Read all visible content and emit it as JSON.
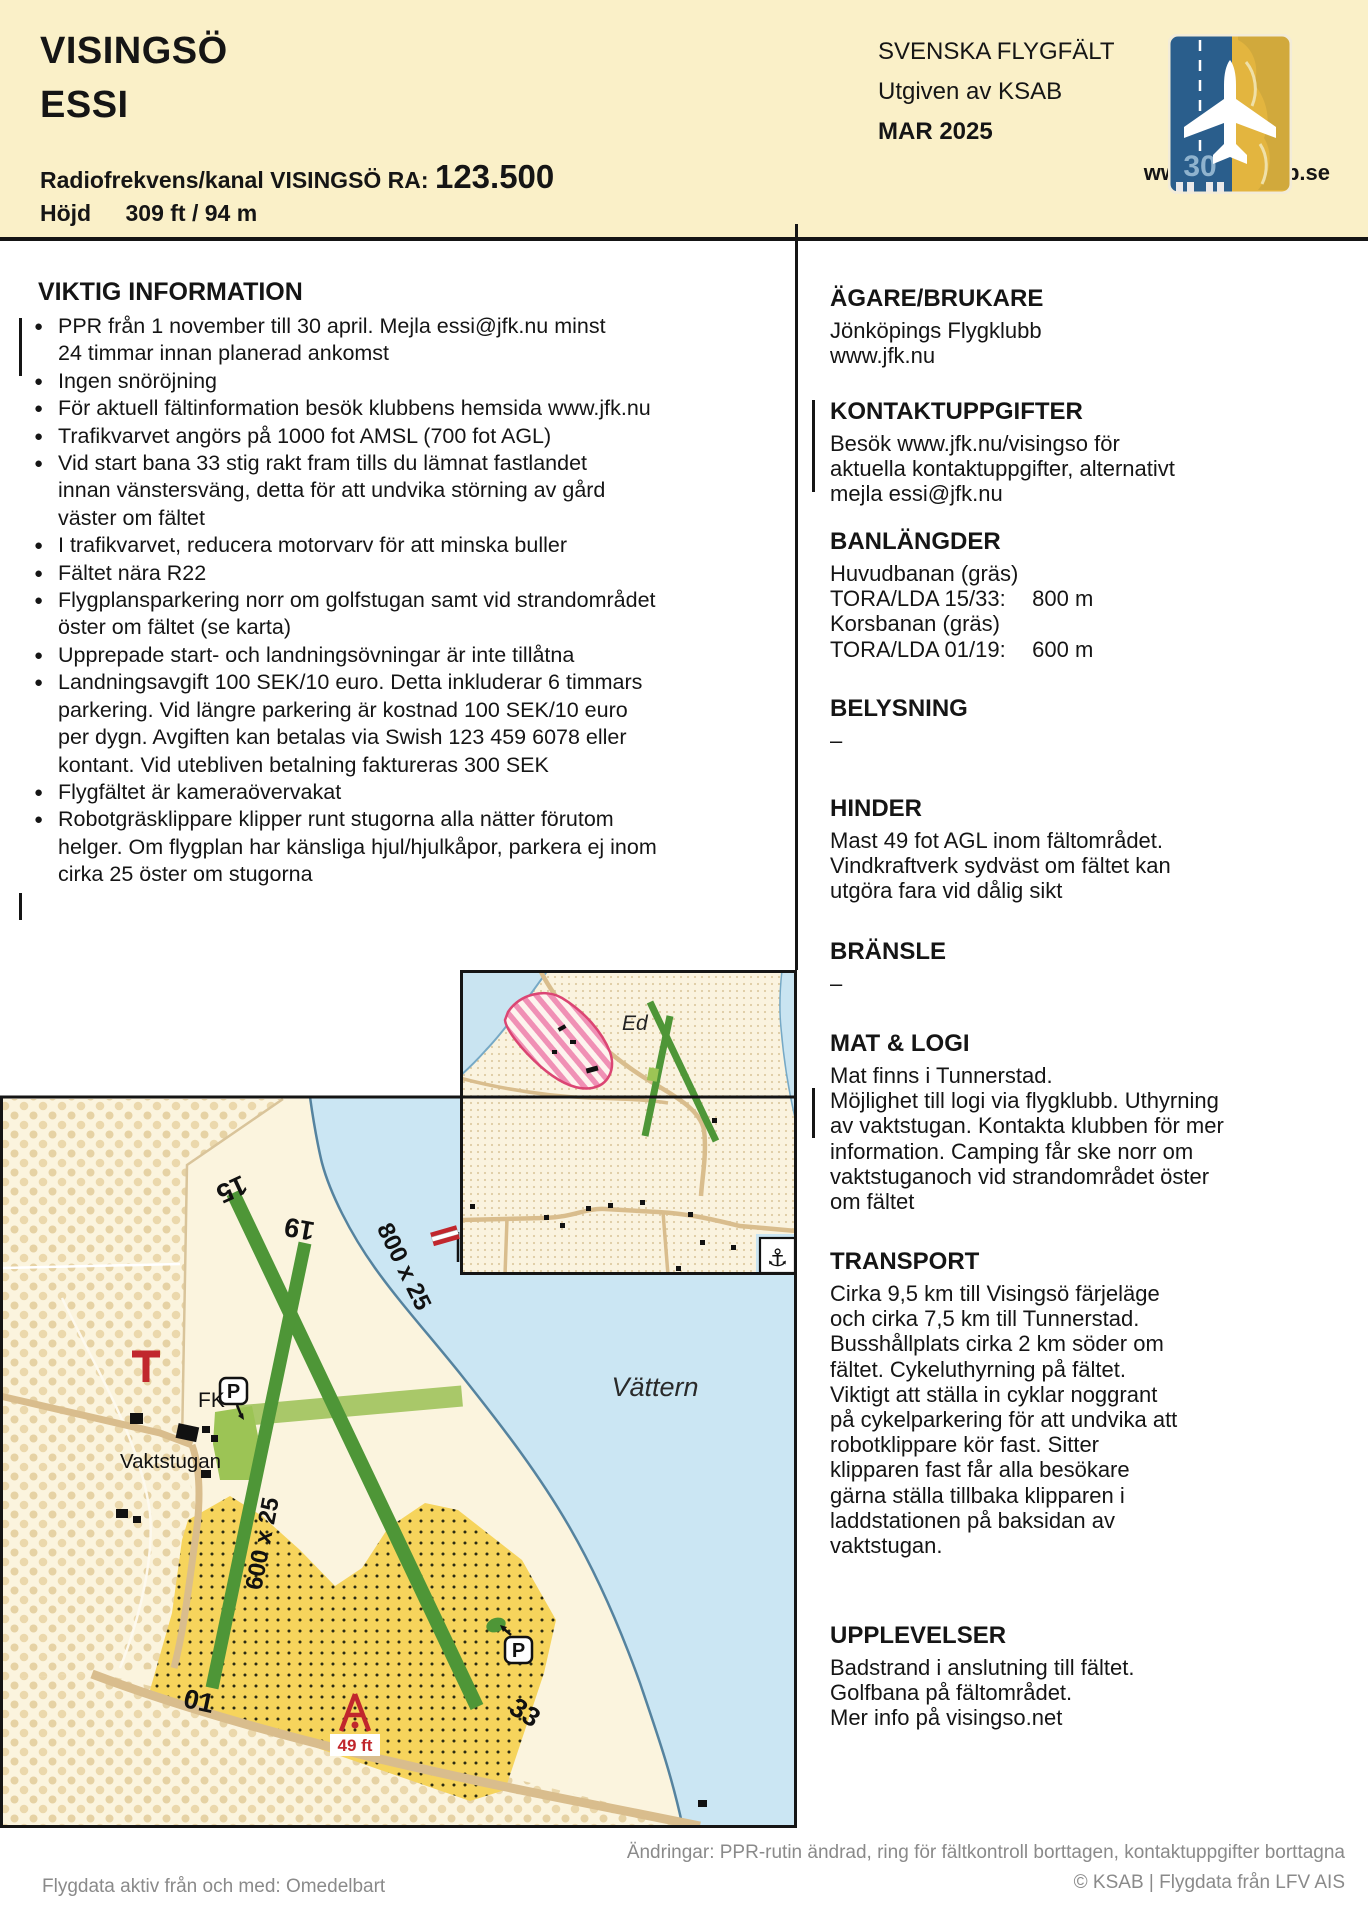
{
  "header": {
    "title_line1": "VISINGSÖ",
    "title_line2": "ESSI",
    "radio_label": "Radiofrekvens/kanal VISINGSÖ RA:",
    "radio_value": "123.500",
    "elevation_label": "Höjd",
    "elevation_value": "309 ft / 94 m",
    "series_title": "SVENSKA FLYGFÄLT",
    "publisher": "Utgiven av KSAB",
    "edition": "MAR 2025",
    "website": "www.pilotshop.se",
    "logo_runway_number": "30"
  },
  "important": {
    "heading": "VIKTIG INFORMATION",
    "bullet_marker": "●",
    "bullets": [
      "PPR från 1 november till 30 april. Mejla essi@jfk.nu minst\n24 timmar innan planerad ankomst",
      "Ingen snöröjning",
      "För aktuell fältinformation besök klubbens hemsida www.jfk.nu",
      "Trafikvarvet angörs på 1000 fot AMSL (700 fot AGL)",
      "Vid start bana 33 stig rakt fram tills du lämnat fastlandet\ninnan vänstersväng, detta för att undvika störning av gård\nväster om fältet",
      "I trafikvarvet, reducera motorvarv för att minska buller",
      "Fältet nära R22",
      "Flygplansparkering norr om golfstugan samt vid strandområdet\nöster om fältet (se karta)",
      "Upprepade start- och landningsövningar är inte tillåtna",
      "Landningsavgift 100 SEK/10 euro. Detta inkluderar 6 timmars\nparkering. Vid längre parkering är kostnad 100 SEK/10 euro\nper dygn. Avgiften kan betalas via Swish 123 459 6078 eller\nkontant. Vid utebliven betalning faktureras 300 SEK",
      "Flygfältet är kameraövervakat",
      "Robotgräsklippare klipper runt stugorna alla nätter förutom\nhelger. Om flygplan har känsliga hjul/hjulkåpor, parkera ej inom\ncirka 25 öster om stugorna"
    ]
  },
  "right": {
    "agare": {
      "heading": "ÄGARE/BRUKARE",
      "text": "Jönköpings Flygklubb\nwww.jfk.nu"
    },
    "kontakt": {
      "heading": "KONTAKTUPPGIFTER",
      "text": "Besök www.jfk.nu/visingso för\naktuella kontaktuppgifter, alternativt\nmejla essi@jfk.nu"
    },
    "banlangder": {
      "heading": "BANLÄNGDER",
      "row1": "Huvudbanan (gräs)",
      "row2_label": "TORA/LDA 15/33:",
      "row2_value": "800 m",
      "row3": "Korsbanan (gräs)",
      "row4_label": "TORA/LDA 01/19:",
      "row4_value": "600 m"
    },
    "belysning": {
      "heading": "BELYSNING",
      "text": "–"
    },
    "hinder": {
      "heading": "HINDER",
      "text": "Mast 49 fot AGL inom fältområdet.\nVindkraftverk sydväst om fältet kan\nutgöra fara vid dålig sikt"
    },
    "bransle": {
      "heading": "BRÄNSLE",
      "text": "–"
    },
    "mat": {
      "heading": "MAT & LOGI",
      "text": "Mat finns i Tunnerstad.\nMöjlighet till logi via flygklubb. Uthyrning\nav vaktstugan. Kontakta klubben för mer\ninformation. Camping får ske norr om\nvaktstuganoch vid strandområdet öster\nom fältet"
    },
    "transport": {
      "heading": "TRANSPORT",
      "text": "Cirka 9,5 km till Visingsö färjeläge\noch cirka 7,5 km till Tunnerstad.\nBusshållplats cirka 2 km söder om\nfältet. Cykeluthyrning på fältet.\nViktigt att ställa in cyklar noggrant\npå cykelparkering för att undvika att\nrobotklippare kör fast. Sitter\nklipparen fast får alla besökare\ngärna ställa tillbaka klipparen i\nladdstationen på baksidan av\nvaktstugan."
    },
    "upplevelser": {
      "heading": "UPPLEVELSER",
      "text": "Badstrand i anslutning till fältet.\nGolfbana på fältområdet.\nMer info på visingso.net"
    }
  },
  "map": {
    "water_label": "Vättern",
    "inset_village_label": "Ed",
    "anchor_symbol": "⚓",
    "fk_label": "FK",
    "vaktstugan_label": "Vaktstugan",
    "parking_label": "P",
    "mast_label": "49 ft",
    "rwy_main_dim": "800 x 25",
    "rwy_cross_dim": "600 x 25",
    "thr_15": "15",
    "thr_33": "33",
    "thr_19": "19",
    "thr_01": "01"
  },
  "footer": {
    "effective": "Flygdata aktiv från och med: Omedelbart",
    "changes": "Ändringar: PPR-rutin ändrad, ring för fältkontroll borttagen, kontaktuppgifter borttagna",
    "copyright": "© KSAB | Flygdata från LFV AIS"
  },
  "colors": {
    "header_cream": "#faf0c8",
    "water_blue": "#cbe6f3",
    "runway_green": "#4e9637",
    "golf_yellow": "#f6d45c",
    "warning_red": "#c1272d"
  }
}
